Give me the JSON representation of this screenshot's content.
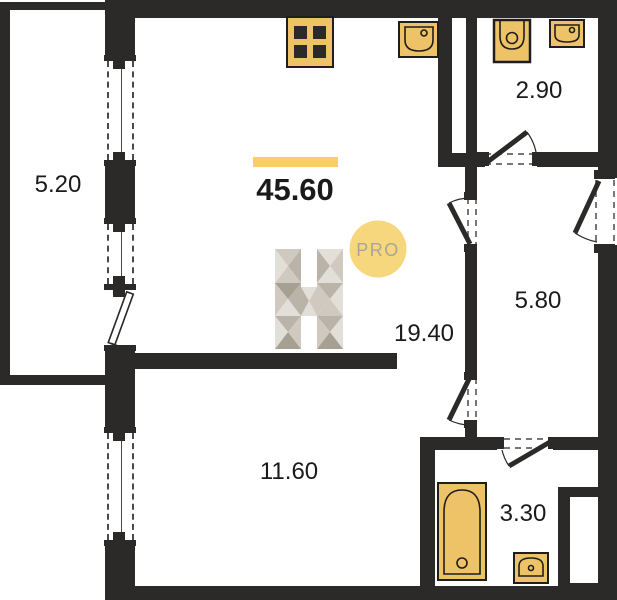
{
  "plan": {
    "total_area": {
      "value": "45.60"
    },
    "rooms": [
      {
        "name": "balcony",
        "area": "5.20"
      },
      {
        "name": "kitchen-living-room",
        "area": "19.40"
      },
      {
        "name": "wc",
        "area": "2.90"
      },
      {
        "name": "hallway",
        "area": "5.80"
      },
      {
        "name": "bedroom",
        "area": "11.60"
      },
      {
        "name": "bathroom",
        "area": "3.30"
      }
    ],
    "watermark": {
      "letter": "H",
      "badge": "PRO"
    },
    "fixtures": [
      "stove-icon",
      "kitchen-sink-icon",
      "toilet-icon",
      "wc-sink-icon",
      "bathtub-icon",
      "bathroom-sink-icon"
    ],
    "colors": {
      "wall": "#2b2a28",
      "fixture_fill": "#eec266",
      "fixture_stroke": "#1f1e1c",
      "accent_bar": "#f7cf63",
      "badge_fill": "#f7d77e",
      "badge_text": "#a5a59c",
      "window_line": "#4a4a48",
      "label_text": "#1a1a1a",
      "logo_1": "#e2ded8",
      "logo_2": "#cfc9c0",
      "logo_3": "#bab3a8",
      "logo_4": "#a6a092"
    }
  }
}
